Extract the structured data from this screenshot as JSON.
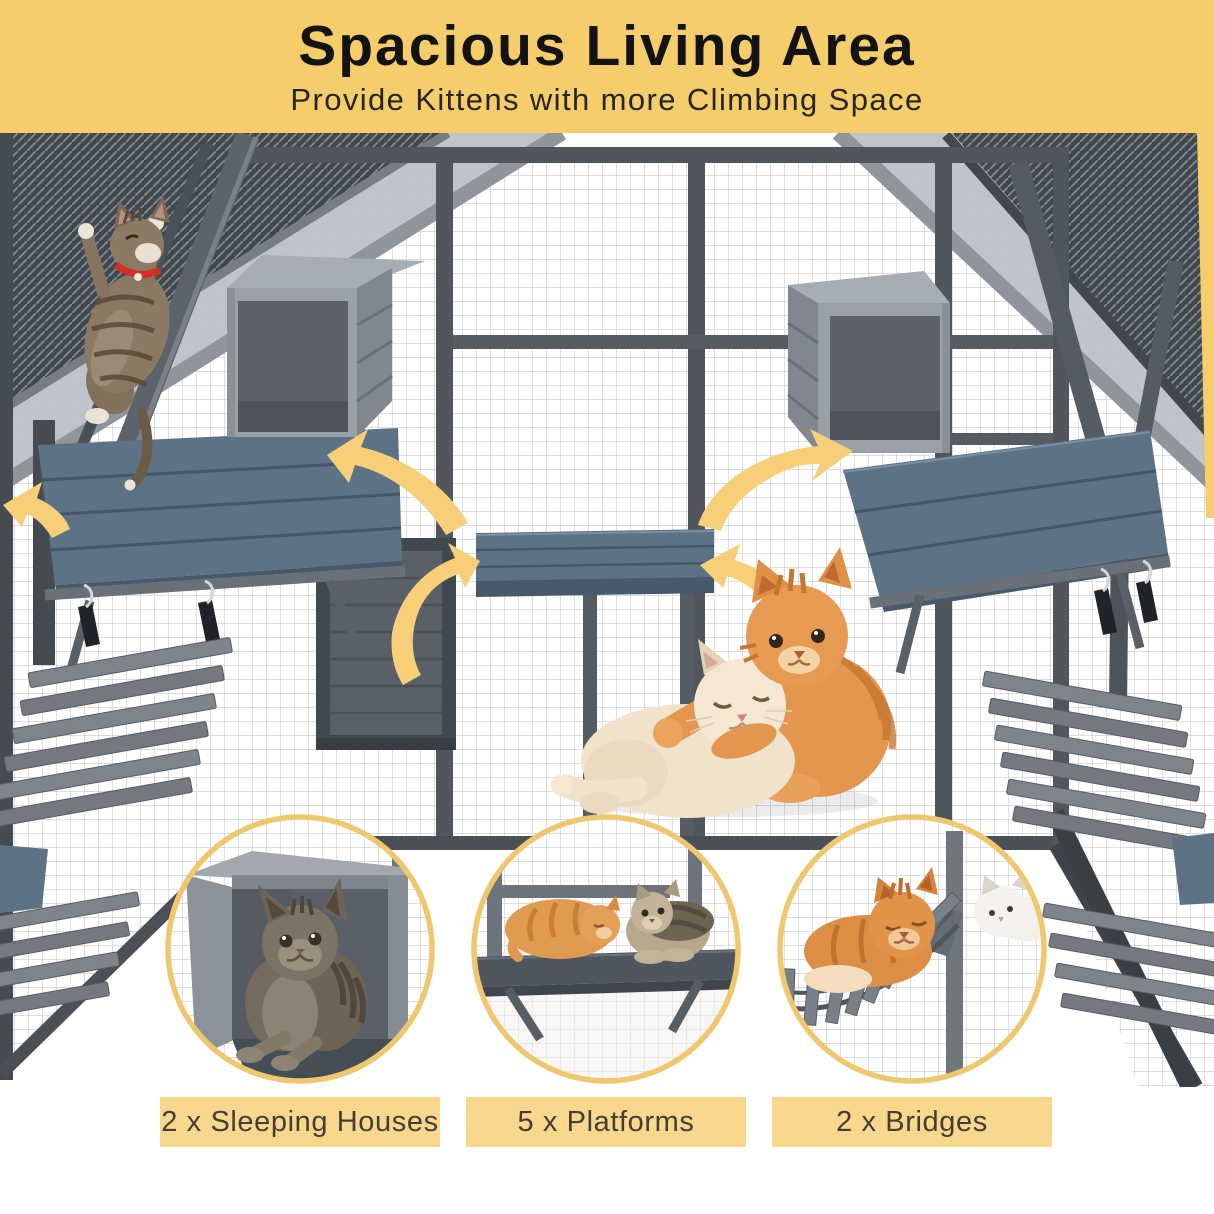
{
  "banner": {
    "title": "Spacious Living Area",
    "subtitle": "Provide Kittens with more Climbing Space",
    "bg_color": "#F6CD6B"
  },
  "features": [
    {
      "label": "2 x Sleeping Houses"
    },
    {
      "label": "5 x Platforms"
    },
    {
      "label": "2 x Bridges"
    }
  ],
  "scene": {
    "icons": [
      "curved-arrow-icon",
      "curved-arrow-icon",
      "curved-arrow-icon",
      "curved-arrow-icon",
      "curved-arrow-icon"
    ],
    "subjects": [
      "climbing-tabby-cat",
      "hugging-orange-and-cream-kittens",
      "kitten-in-sleeping-house",
      "two-kittens-on-platform",
      "two-cats-on-bridge"
    ]
  },
  "palette": {
    "banner_yellow": "#F6CD6B",
    "label_yellow": "#F9D78D",
    "ring_gold": "#EFC76F",
    "arrow_yellow": "#F7CF78",
    "platform_blue": "#5D7284",
    "frame_gray": "#565C63",
    "mesh_gray": "#C6CAD0",
    "title_text": "#131313"
  }
}
